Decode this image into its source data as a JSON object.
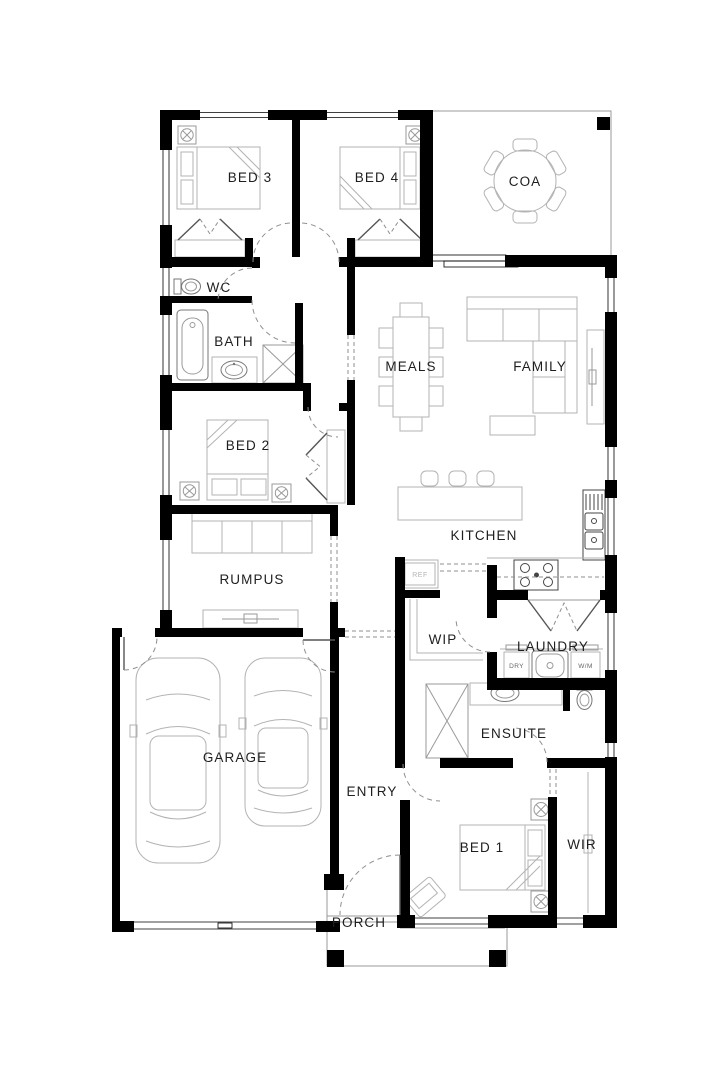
{
  "plan_title": "Single storey house floor plan",
  "colors": {
    "wall": "#000000",
    "furniture_line": "#b3b3b3",
    "label": "#1e1e1e"
  },
  "rooms": [
    {
      "id": "bed3",
      "label": "BED 3"
    },
    {
      "id": "bed4",
      "label": "BED 4"
    },
    {
      "id": "coa",
      "label": "COA"
    },
    {
      "id": "wc",
      "label": "WC"
    },
    {
      "id": "bath",
      "label": "BATH"
    },
    {
      "id": "meals",
      "label": "MEALS"
    },
    {
      "id": "family",
      "label": "FAMILY"
    },
    {
      "id": "bed2",
      "label": "BED 2"
    },
    {
      "id": "kitchen",
      "label": "KITCHEN"
    },
    {
      "id": "rumpus",
      "label": "RUMPUS"
    },
    {
      "id": "wip",
      "label": "WIP"
    },
    {
      "id": "laundry",
      "label": "LAUNDRY"
    },
    {
      "id": "ensuite",
      "label": "ENSUITE"
    },
    {
      "id": "garage",
      "label": "GARAGE"
    },
    {
      "id": "entry",
      "label": "ENTRY"
    },
    {
      "id": "bed1",
      "label": "BED 1"
    },
    {
      "id": "wir",
      "label": "WIR"
    },
    {
      "id": "porch",
      "label": "PORCH"
    }
  ],
  "appliances": {
    "fridge": "REF",
    "dryer": "DRY",
    "washer": "W/M"
  }
}
